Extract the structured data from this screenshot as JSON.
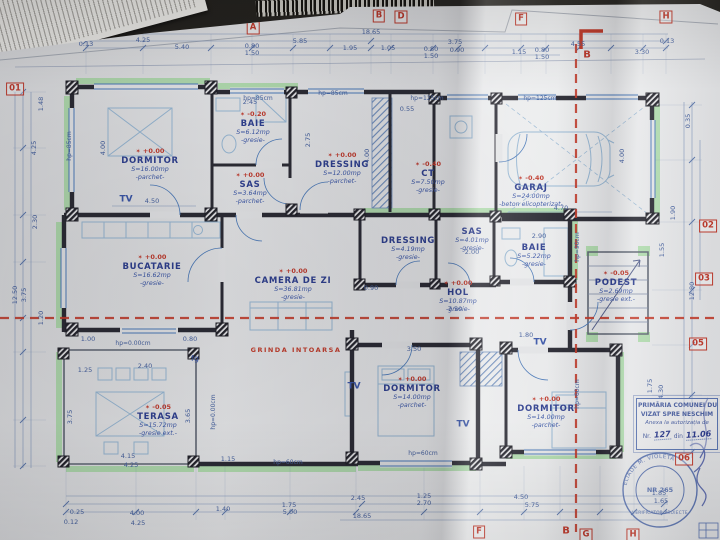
{
  "icons": {
    "level_mark": "✶",
    "receipt": "thermal-receipt",
    "barcode": "barcode-sticker"
  },
  "colors": {
    "paper": "#e4e5e7",
    "ink_blue": "#2e3f8f",
    "dim_blue": "#46619e",
    "wall": "#2b2b34",
    "green_highlight": "#a4d8a0",
    "section_red": "#c23b2a",
    "fixture_blue": "#97b7d3"
  },
  "rooms": [
    {
      "name": "DORMITOR",
      "area": "S=16.00mp",
      "finish": "-parchet-",
      "level": "+0.00",
      "x": 150,
      "y": 166
    },
    {
      "name": "BAIE",
      "area": "S=6.12mp",
      "finish": "-gresie-",
      "level": "-0.20",
      "x": 253,
      "y": 129
    },
    {
      "name": "SAS",
      "area": "S=3.64mp",
      "finish": "-parchet-",
      "level": "+0.00",
      "x": 250,
      "y": 190
    },
    {
      "name": "DRESSING",
      "area": "S=12.00mp",
      "finish": "-parchet-",
      "level": "+0.00",
      "x": 342,
      "y": 170
    },
    {
      "name": "CT",
      "area": "S=7.50mp",
      "finish": "-gresie-",
      "level": "-0.40",
      "x": 428,
      "y": 179
    },
    {
      "name": "GARAJ",
      "area": "S=24.00mp",
      "finish": "-beton elicopterizat-",
      "level": "-0.40",
      "x": 531,
      "y": 193
    },
    {
      "name": "BUCATARIE",
      "area": "S=16.62mp",
      "finish": "-gresie-",
      "level": "+0.00",
      "x": 152,
      "y": 272
    },
    {
      "name": "CAMERA DE ZI",
      "area": "S=36.81mp",
      "finish": "-gresie-",
      "level": "+0.00",
      "x": 293,
      "y": 286
    },
    {
      "name": "DRESSING",
      "area": "S=4.19mp",
      "finish": "-gresie-",
      "level": "",
      "x": 408,
      "y": 250
    },
    {
      "name": "SAS",
      "area": "S=4.01mp",
      "finish": "-gresie-",
      "level": "",
      "x": 472,
      "y": 241
    },
    {
      "name": "BAIE",
      "area": "S=5.22mp",
      "finish": "-gresie-",
      "level": "",
      "x": 534,
      "y": 257
    },
    {
      "name": "HOL",
      "area": "S=10.87mp",
      "finish": "-gresie-",
      "level": "+0.00",
      "x": 458,
      "y": 298
    },
    {
      "name": "PODEST",
      "area": "S=2.69mp",
      "finish": "-gresie ext.-",
      "level": "-0.05",
      "x": 616,
      "y": 288
    },
    {
      "name": "TERASA",
      "area": "S=15.72mp",
      "finish": "-gresie ext.-",
      "level": "-0.05",
      "x": 158,
      "y": 422
    },
    {
      "name": "DORMITOR",
      "area": "S=14.00mp",
      "finish": "-parchet-",
      "level": "+0.00",
      "x": 412,
      "y": 394
    },
    {
      "name": "DORMITOR",
      "area": "S=14.00mp",
      "finish": "-parchet-",
      "level": "+0.00",
      "x": 546,
      "y": 414
    }
  ],
  "dims": [
    {
      "t": "0.13",
      "x": 86,
      "y": 44
    },
    {
      "t": "4.25",
      "x": 143,
      "y": 40
    },
    {
      "t": "5.40",
      "x": 182,
      "y": 47
    },
    {
      "t": "0.80",
      "x": 252,
      "y": 46
    },
    {
      "t": "1.50",
      "x": 252,
      "y": 53
    },
    {
      "t": "5.85",
      "x": 300,
      "y": 41
    },
    {
      "t": "1.95",
      "x": 350,
      "y": 48
    },
    {
      "t": "18.65",
      "x": 371,
      "y": 32
    },
    {
      "t": "1.05",
      "x": 388,
      "y": 48
    },
    {
      "t": "3.75",
      "x": 455,
      "y": 42
    },
    {
      "t": "0.80",
      "x": 431,
      "y": 49
    },
    {
      "t": "1.50",
      "x": 431,
      "y": 56
    },
    {
      "t": "0.90",
      "x": 457,
      "y": 50
    },
    {
      "t": "1.15",
      "x": 519,
      "y": 52
    },
    {
      "t": "0.80",
      "x": 542,
      "y": 50
    },
    {
      "t": "1.50",
      "x": 542,
      "y": 57
    },
    {
      "t": "4.55",
      "x": 578,
      "y": 44
    },
    {
      "t": "3.30",
      "x": 642,
      "y": 52
    },
    {
      "t": "0.13",
      "x": 667,
      "y": 41
    },
    {
      "t": "12.50",
      "x": 15,
      "y": 295,
      "v": true
    },
    {
      "t": "3.75",
      "x": 24,
      "y": 295,
      "v": true
    },
    {
      "t": "4.25",
      "x": 34,
      "y": 148,
      "v": true
    },
    {
      "t": "1.48",
      "x": 41,
      "y": 104,
      "v": true
    },
    {
      "t": "2.30",
      "x": 35,
      "y": 222,
      "v": true
    },
    {
      "t": "1.20",
      "x": 41,
      "y": 318,
      "v": true
    },
    {
      "t": "0.35",
      "x": 688,
      "y": 121,
      "v": true
    },
    {
      "t": "1.90",
      "x": 673,
      "y": 213,
      "v": true
    },
    {
      "t": "1.55",
      "x": 662,
      "y": 250,
      "v": true
    },
    {
      "t": "12.80",
      "x": 692,
      "y": 291,
      "v": true
    },
    {
      "t": "1.75",
      "x": 650,
      "y": 386,
      "v": true
    },
    {
      "t": "4.30",
      "x": 661,
      "y": 392,
      "v": true
    },
    {
      "t": "0.25",
      "x": 77,
      "y": 512
    },
    {
      "t": "4.00",
      "x": 137,
      "y": 513
    },
    {
      "t": "0.12",
      "x": 71,
      "y": 522
    },
    {
      "t": "4.25",
      "x": 138,
      "y": 523
    },
    {
      "t": "1.40",
      "x": 223,
      "y": 509
    },
    {
      "t": "1.75",
      "x": 289,
      "y": 505
    },
    {
      "t": "5.00",
      "x": 290,
      "y": 512
    },
    {
      "t": "2.45",
      "x": 358,
      "y": 498
    },
    {
      "t": "18.65",
      "x": 362,
      "y": 516
    },
    {
      "t": "1.25",
      "x": 424,
      "y": 496
    },
    {
      "t": "2.70",
      "x": 424,
      "y": 503
    },
    {
      "t": "4.50",
      "x": 521,
      "y": 497
    },
    {
      "t": "5.75",
      "x": 532,
      "y": 505
    },
    {
      "t": "1.85",
      "x": 659,
      "y": 493
    },
    {
      "t": "1.65",
      "x": 661,
      "y": 501
    },
    {
      "t": "4.50",
      "x": 152,
      "y": 201
    },
    {
      "t": "2.45",
      "x": 250,
      "y": 102
    },
    {
      "t": "4.00",
      "x": 103,
      "y": 148,
      "v": true
    },
    {
      "t": "2.75",
      "x": 308,
      "y": 140,
      "v": true
    },
    {
      "t": "4.00",
      "x": 367,
      "y": 156,
      "v": true
    },
    {
      "t": "0.55",
      "x": 407,
      "y": 109
    },
    {
      "t": "4.70",
      "x": 561,
      "y": 208
    },
    {
      "t": "4.00",
      "x": 622,
      "y": 156,
      "v": true
    },
    {
      "t": "2.90",
      "x": 539,
      "y": 236
    },
    {
      "t": "2.00",
      "x": 472,
      "y": 252
    },
    {
      "t": "7.50",
      "x": 455,
      "y": 309
    },
    {
      "t": "1.80",
      "x": 526,
      "y": 335
    },
    {
      "t": "3.50",
      "x": 414,
      "y": 349
    },
    {
      "t": "3.65",
      "x": 188,
      "y": 416,
      "v": true
    },
    {
      "t": "3.75",
      "x": 70,
      "y": 417,
      "v": true
    },
    {
      "t": "4.15",
      "x": 128,
      "y": 456
    },
    {
      "t": "4.25",
      "x": 131,
      "y": 465
    },
    {
      "t": "1.15",
      "x": 228,
      "y": 459
    },
    {
      "t": "0.90",
      "x": 371,
      "y": 288
    },
    {
      "t": "1.00",
      "x": 88,
      "y": 339
    },
    {
      "t": "0.80",
      "x": 190,
      "y": 339
    },
    {
      "t": "2.40",
      "x": 145,
      "y": 366
    },
    {
      "t": "1.25",
      "x": 85,
      "y": 370
    }
  ],
  "notes": [
    {
      "t": "TV",
      "x": 126,
      "y": 200,
      "cls": "tv",
      "n": "tv-label"
    },
    {
      "t": "TV",
      "x": 354,
      "y": 387,
      "cls": "tv",
      "n": "tv-label"
    },
    {
      "t": "TV",
      "x": 463,
      "y": 425,
      "cls": "tv",
      "n": "tv-label"
    },
    {
      "t": "TV",
      "x": 540,
      "y": 343,
      "cls": "tv",
      "n": "tv-label"
    },
    {
      "t": "fg",
      "x": 195,
      "y": 359,
      "cls": "fg",
      "n": "fridge-label"
    },
    {
      "t": "GRINDA INTOARSA",
      "x": 296,
      "y": 350,
      "cls": "red-note",
      "n": "grinda-intoarsa-note"
    },
    {
      "t": "hp=85cm",
      "x": 258,
      "y": 99,
      "cls": "hp",
      "n": "window-sill-height-label"
    },
    {
      "t": "hp=85cm",
      "x": 333,
      "y": 94,
      "cls": "hp",
      "n": "window-sill-height-label"
    },
    {
      "t": "hp=125cm",
      "x": 427,
      "y": 99,
      "cls": "hp",
      "n": "window-sill-height-label"
    },
    {
      "t": "hp=125cm",
      "x": 540,
      "y": 99,
      "cls": "hp",
      "n": "window-sill-height-label"
    },
    {
      "t": "hp=85cm",
      "x": 70,
      "y": 146,
      "v": true,
      "cls": "hp",
      "n": "window-sill-height-label"
    },
    {
      "t": "hp=0.00cm",
      "x": 214,
      "y": 412,
      "v": true,
      "cls": "hp",
      "n": "window-sill-height-label"
    },
    {
      "t": "hp=90cm",
      "x": 578,
      "y": 247,
      "v": true,
      "cls": "hp",
      "n": "window-sill-height-label"
    },
    {
      "t": "hp=60cm",
      "x": 578,
      "y": 394,
      "v": true,
      "cls": "hp",
      "n": "window-sill-height-label"
    },
    {
      "t": "hp=0.00cm",
      "x": 133,
      "y": 344,
      "cls": "hp",
      "n": "window-sill-height-label"
    },
    {
      "t": "hp=60cm",
      "x": 288,
      "y": 463,
      "cls": "hp",
      "n": "window-sill-height-label"
    },
    {
      "t": "hp=60cm",
      "x": 423,
      "y": 454,
      "cls": "hp",
      "n": "window-sill-height-label"
    }
  ],
  "markers": {
    "boxed": [
      {
        "t": "A",
        "x": 253,
        "y": 28
      },
      {
        "t": "B",
        "x": 379,
        "y": 16
      },
      {
        "t": "D",
        "x": 401,
        "y": 17
      },
      {
        "t": "F",
        "x": 521,
        "y": 19
      },
      {
        "t": "H",
        "x": 666,
        "y": 17
      },
      {
        "t": "01",
        "x": 15,
        "y": 89
      },
      {
        "t": "02",
        "x": 708,
        "y": 226
      },
      {
        "t": "03",
        "x": 704,
        "y": 279
      },
      {
        "t": "05",
        "x": 698,
        "y": 344
      },
      {
        "t": "06",
        "x": 684,
        "y": 459
      },
      {
        "t": "F",
        "x": 479,
        "y": 532
      },
      {
        "t": "G",
        "x": 586,
        "y": 535
      },
      {
        "t": "H",
        "x": 633,
        "y": 535
      }
    ],
    "plain": [
      {
        "t": "B",
        "x": 587,
        "y": 55
      },
      {
        "t": "B",
        "x": 566,
        "y": 531
      }
    ]
  },
  "stamp": {
    "authority": "PRIMĂRIA COMUNEI DUM",
    "visa": "VIZAT SPRE NESCHIM",
    "annex": "Anexa la autorizația de",
    "nr_label": "Nr.",
    "nr_value": "127",
    "din_label": "din",
    "date_value": "11.06"
  },
  "round_stamp": {
    "arc_top": "ELIADE M. VIOLETA",
    "arc_bottom": "VERIFICATOR PROIECTE",
    "center": "NR 265"
  }
}
